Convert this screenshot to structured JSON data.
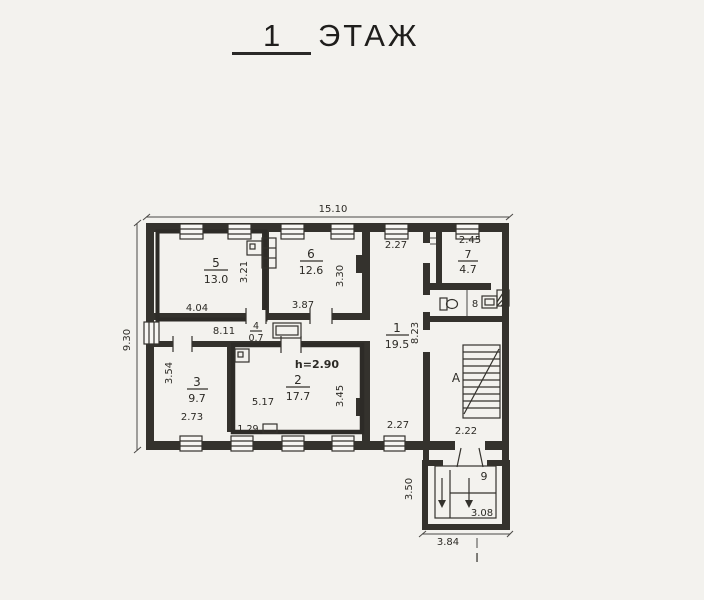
{
  "title": {
    "floor_number": "1",
    "floor_word": "ЭТАЖ"
  },
  "dimensions": {
    "building_width": "15.10",
    "building_depth": "9.30",
    "hall_length": "8.11"
  },
  "rooms": {
    "corridor": {
      "number": "1",
      "area": "19.5",
      "width_top": "2.27",
      "length": "8.23",
      "width_bottom": "2.27"
    },
    "room2": {
      "number": "2",
      "area": "17.7",
      "width": "5.17",
      "depth": "3.45",
      "offset": "1.29",
      "ceiling": "h=2.90"
    },
    "room3": {
      "number": "3",
      "area": "9.7",
      "width": "2.73",
      "depth": "3.54"
    },
    "room4": {
      "number": "4",
      "area": "0.7"
    },
    "room5": {
      "number": "5",
      "area": "13.0",
      "width": "4.04",
      "depth": "3.21"
    },
    "room6": {
      "number": "6",
      "area": "12.6",
      "width": "3.87",
      "depth": "3.30"
    },
    "room7": {
      "number": "7",
      "area": "4.7",
      "width": "2.45"
    },
    "room8": {
      "number": "8"
    },
    "room9": {
      "number": "9",
      "width": "3.08"
    },
    "stair_hall": {
      "letter": "А",
      "width": "2.22"
    },
    "vestibule": {
      "depth": "3.50",
      "width": "3.84"
    },
    "entrance": {
      "mark": "I"
    }
  },
  "colors": {
    "ink": "#34322d",
    "paper": "#f3f2ee"
  }
}
